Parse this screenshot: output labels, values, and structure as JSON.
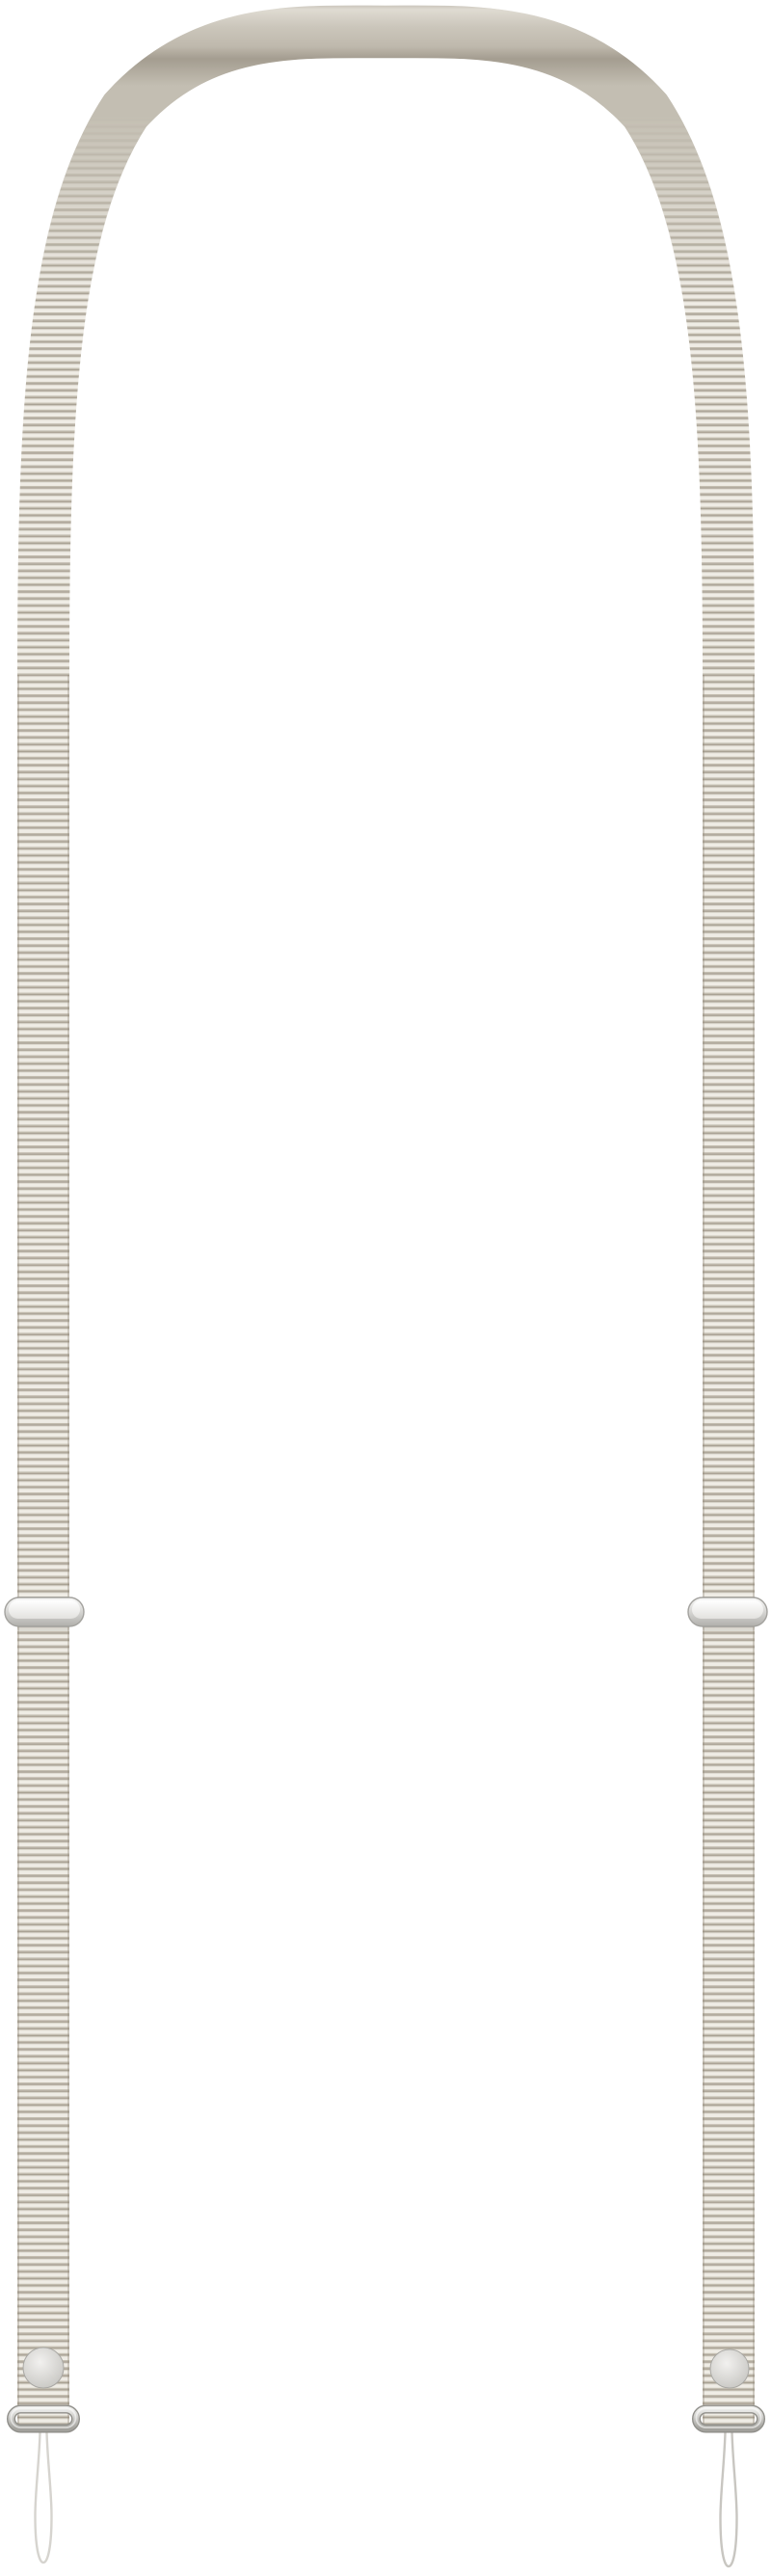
{
  "product": {
    "kind": "lanyard-strap-photo"
  },
  "colors": {
    "background": "#ffffff",
    "rib_light": "#efece5",
    "rib_soft": "#d8d3c9",
    "rib_dark": "#a8a193",
    "rib_mid": "#c6c0b3",
    "arch_edge_top": "#b0aa9f",
    "arch_highlight": "#dfdbd2",
    "arch_mid": "#cbc6bb",
    "arch_lower": "#bfb9ad",
    "arch_inner_shadow": "#a49d90",
    "arch_side": "#c3beb2",
    "strap_edge_shade": "#8f8878",
    "slider_stroke": "#a3a29e",
    "slider_top": "#fbfbfa",
    "slider_bottom": "#b0afab",
    "slider_inner_top": "#ffffff",
    "slider_inner_bottom": "#e3e2df",
    "snap_center": "#f2f1ef",
    "snap_edge": "#c5c4c0",
    "snap_stroke": "#a9a8a4",
    "ring_outline": "#908f8a",
    "ring_light": "#ececea",
    "ring_dark": "#a2a19c",
    "ring_highlight": "rgba(255,255,255,0.55)",
    "cord_left": "#d6d4cf",
    "cord_right": "#c8c6c1",
    "cord_fill": "#ffffff",
    "shadow": "rgba(60,55,45,0.10)"
  },
  "parts": {
    "strap": "ribbed woven strap",
    "arch": "smooth strap back over top arch",
    "left_slider": "metal adjuster slider (left)",
    "right_slider": "metal adjuster slider (right)",
    "left_snap": "metal snap button (left)",
    "right_snap": "metal snap button (right)",
    "left_ring": "metal end ring (left)",
    "right_ring": "metal end ring (right)",
    "left_cord": "cord attachment loop (left)",
    "right_cord": "cord attachment loop (right)"
  }
}
